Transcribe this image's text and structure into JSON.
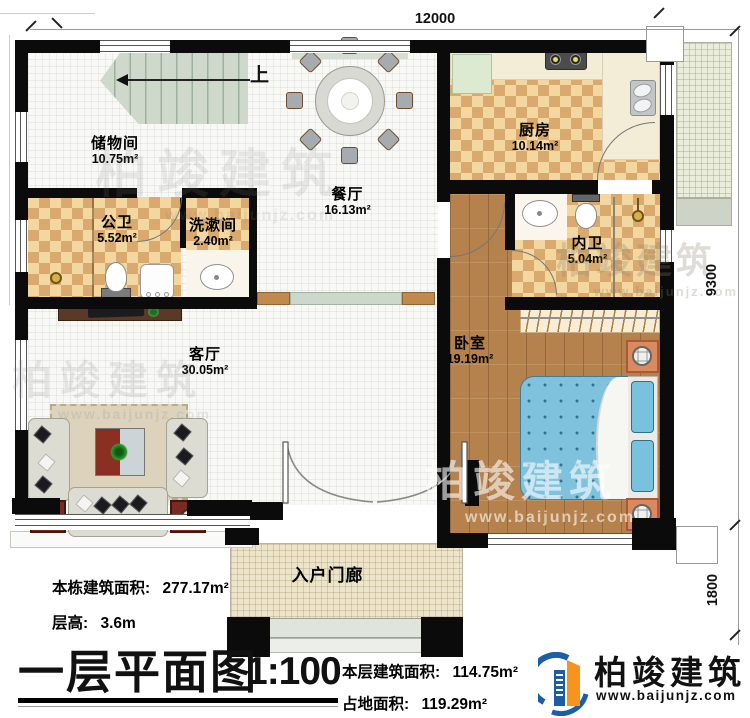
{
  "plan": {
    "title": "一层平面图",
    "scale": "1:100",
    "up_label": "上",
    "dimensions": {
      "width_top": "12000",
      "height_right": "9300",
      "porch_right": "1800"
    },
    "rooms": [
      {
        "name": "储物间",
        "area": "10.75m²"
      },
      {
        "name": "公卫",
        "area": "5.52m²"
      },
      {
        "name": "洗漱间",
        "area": "2.40m²"
      },
      {
        "name": "餐厅",
        "area": "16.13m²"
      },
      {
        "name": "厨房",
        "area": "10.14m²"
      },
      {
        "name": "内卫",
        "area": "5.04m²"
      },
      {
        "name": "卧室",
        "area": "19.19m²"
      },
      {
        "name": "客厅",
        "area": "30.05m²"
      },
      {
        "name": "入户门廊",
        "area": ""
      }
    ]
  },
  "annotations": {
    "building_area_label": "本栋建筑面积:",
    "building_area_value": "277.17m²",
    "floor_height_label": "层高:",
    "floor_height_value": "3.6m",
    "floor_area_label": "本层建筑面积:",
    "floor_area_value": "114.75m²",
    "land_area_label": "占地面积:",
    "land_area_value": "119.29m²"
  },
  "logo": {
    "name": "柏竣建筑",
    "website": "www.baijunjz.com"
  },
  "watermark": {
    "text": "柏竣建筑",
    "website": "www.baijunjz.com"
  },
  "colors": {
    "wall": "#0b0b0b",
    "checker_light": "#f2d7a0",
    "checker_dark": "#d9a96e",
    "wood_floor": "#b5824d",
    "stairs": "#cfd9cb",
    "bed": "#7fc2dd",
    "nightstand": "#d98a5e",
    "logo_blue": "#1b5ea6",
    "logo_orange": "#f7941d"
  }
}
